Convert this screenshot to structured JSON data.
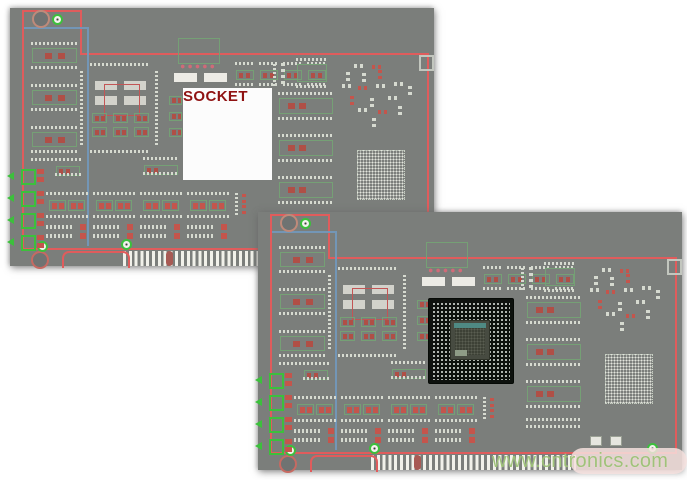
{
  "page": {
    "background": "#ffffff"
  },
  "colors": {
    "board_gray": "#7b7e7b",
    "outline_red": "#e05c5c",
    "trace_blue": "#7396b6",
    "silk_green": "#75a075",
    "connector_green": "#3cc03c",
    "pad_red": "#b04f46",
    "pad_red2": "#c4554c",
    "pad_light": "#d6dad0",
    "chip_black": "#0e120e",
    "socket_white": "#fcfcfc",
    "socket_label_red": "#8f1212",
    "watermark_green": "#9dc276"
  },
  "boards": {
    "socket_board": {
      "center_label": "SOCKET"
    },
    "bga_board": {
      "center_component": "bga-chip"
    }
  },
  "watermark": {
    "text": "www.cntronics.com"
  }
}
